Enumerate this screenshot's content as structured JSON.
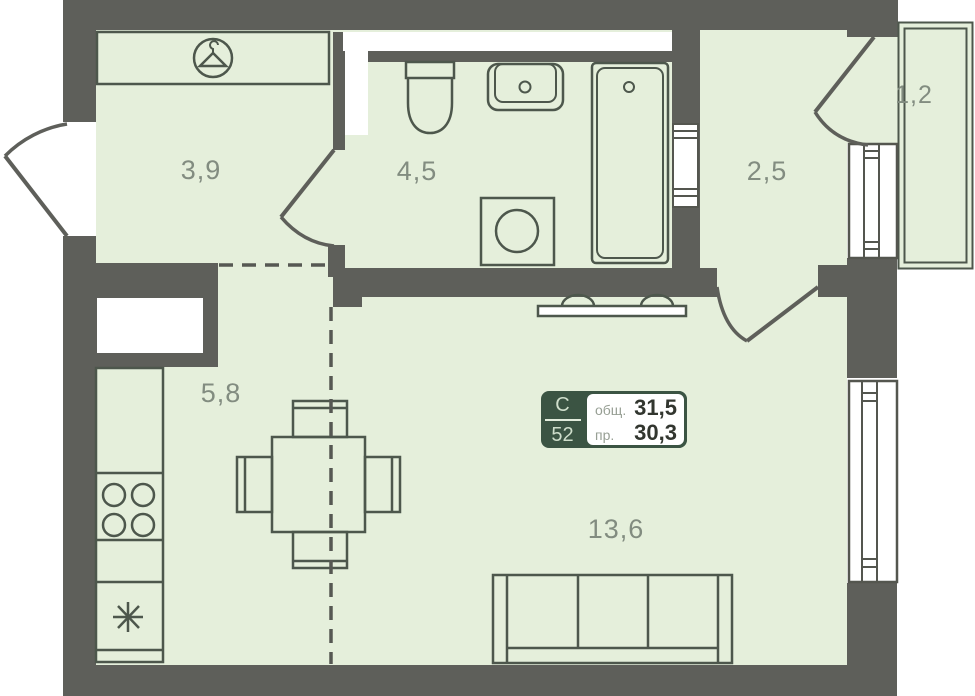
{
  "rooms": {
    "dressing": {
      "label": "3,9"
    },
    "bathroom": {
      "label": "4,5"
    },
    "hallway": {
      "label": "2,5"
    },
    "loggia": {
      "label": "1,2"
    },
    "kitchen": {
      "label": "5,8"
    },
    "living": {
      "label": "13,6"
    }
  },
  "info_box": {
    "type_letter": "С",
    "apartment_number": "52",
    "rows": [
      {
        "label": "общ.",
        "value": "31,5"
      },
      {
        "label": "пр.",
        "value": "30,3"
      }
    ]
  },
  "icons": {
    "wardrobe": "hanger-icon",
    "fridge": "snowflake-icon",
    "stove": "burner-rings-icon"
  },
  "colors": {
    "wall": "#5e5f5a",
    "floor": "#e5efdb",
    "line": "#4d574c",
    "info_green": "#3b5443"
  }
}
